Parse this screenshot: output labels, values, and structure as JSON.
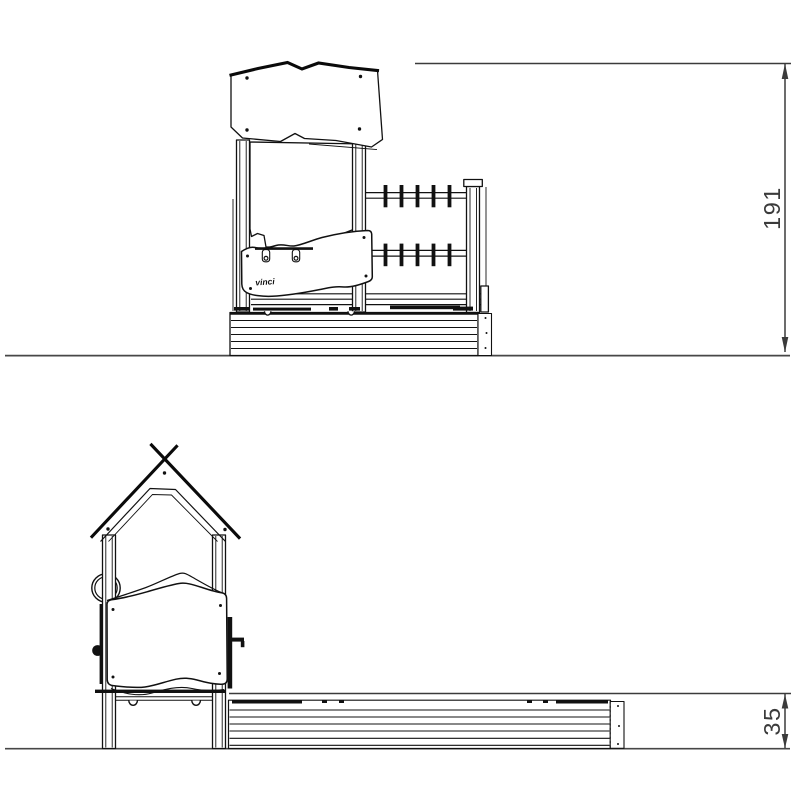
{
  "drawing": {
    "background": "#ffffff",
    "colors": {
      "line": "#111111",
      "dimension": "#3b3b3b",
      "ground": "#474747"
    },
    "views": {
      "side_elevation": {
        "name": "side-elevation-tower-with-net-climber",
        "dimension_label": "191"
      },
      "front_elevation": {
        "name": "front-elevation-playhouse-with-sandbox",
        "dimension_label": "35"
      }
    },
    "logo_text": "vinci"
  }
}
